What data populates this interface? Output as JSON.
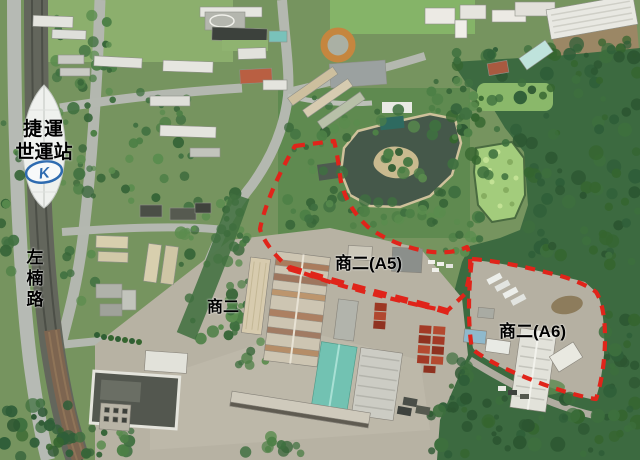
{
  "photo": {
    "station_sign": {
      "line1": "捷運",
      "line2": "世運站",
      "logo_letter": "K"
    },
    "road_sign": "左楠路",
    "zones": {
      "c2": "商二",
      "c2_a5": "商二(A5)",
      "c2_a6": "商二(A6)"
    },
    "annotation_color": "#e0241a"
  }
}
